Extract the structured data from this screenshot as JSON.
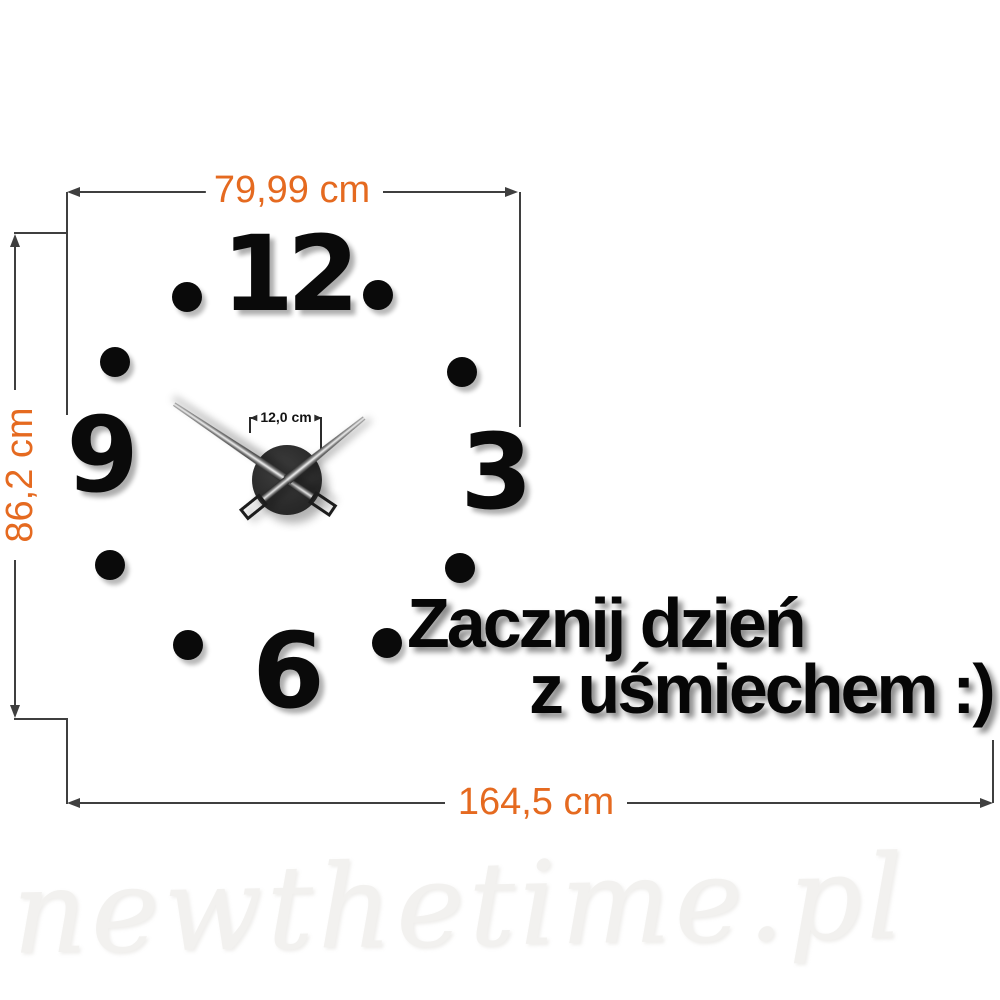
{
  "dimensions": {
    "top": {
      "label": "79,99 cm"
    },
    "left": {
      "label": "86,2 cm"
    },
    "bottom": {
      "label": "164,5 cm"
    },
    "hub": {
      "label": "12,0 cm"
    }
  },
  "clock": {
    "numbers": [
      {
        "label": "12",
        "x": 287,
        "y": 274
      },
      {
        "label": "3",
        "x": 493,
        "y": 472
      },
      {
        "label": "6",
        "x": 285,
        "y": 671
      },
      {
        "label": "9",
        "x": 99,
        "y": 455
      }
    ],
    "dots": [
      {
        "hour": 1,
        "x": 378,
        "y": 295
      },
      {
        "hour": 2,
        "x": 462,
        "y": 372
      },
      {
        "hour": 4,
        "x": 460,
        "y": 568
      },
      {
        "hour": 5,
        "x": 387,
        "y": 643
      },
      {
        "hour": 7,
        "x": 188,
        "y": 645
      },
      {
        "hour": 8,
        "x": 110,
        "y": 565
      },
      {
        "hour": 10,
        "x": 115,
        "y": 362
      },
      {
        "hour": 11,
        "x": 187,
        "y": 297
      }
    ],
    "hands": {
      "minute": {
        "angle_deg": 213.9,
        "length_px": 136
      },
      "hour": {
        "angle_deg": -38.8,
        "length_px": 99
      }
    }
  },
  "slogan": {
    "line1": "Zacznij dzień",
    "line2": "z uśmiechem :)"
  },
  "watermark": "newthetime.pl",
  "colors": {
    "accent": "#e56a20",
    "line": "#3f3f3f",
    "ink": "#0a0a0a"
  }
}
